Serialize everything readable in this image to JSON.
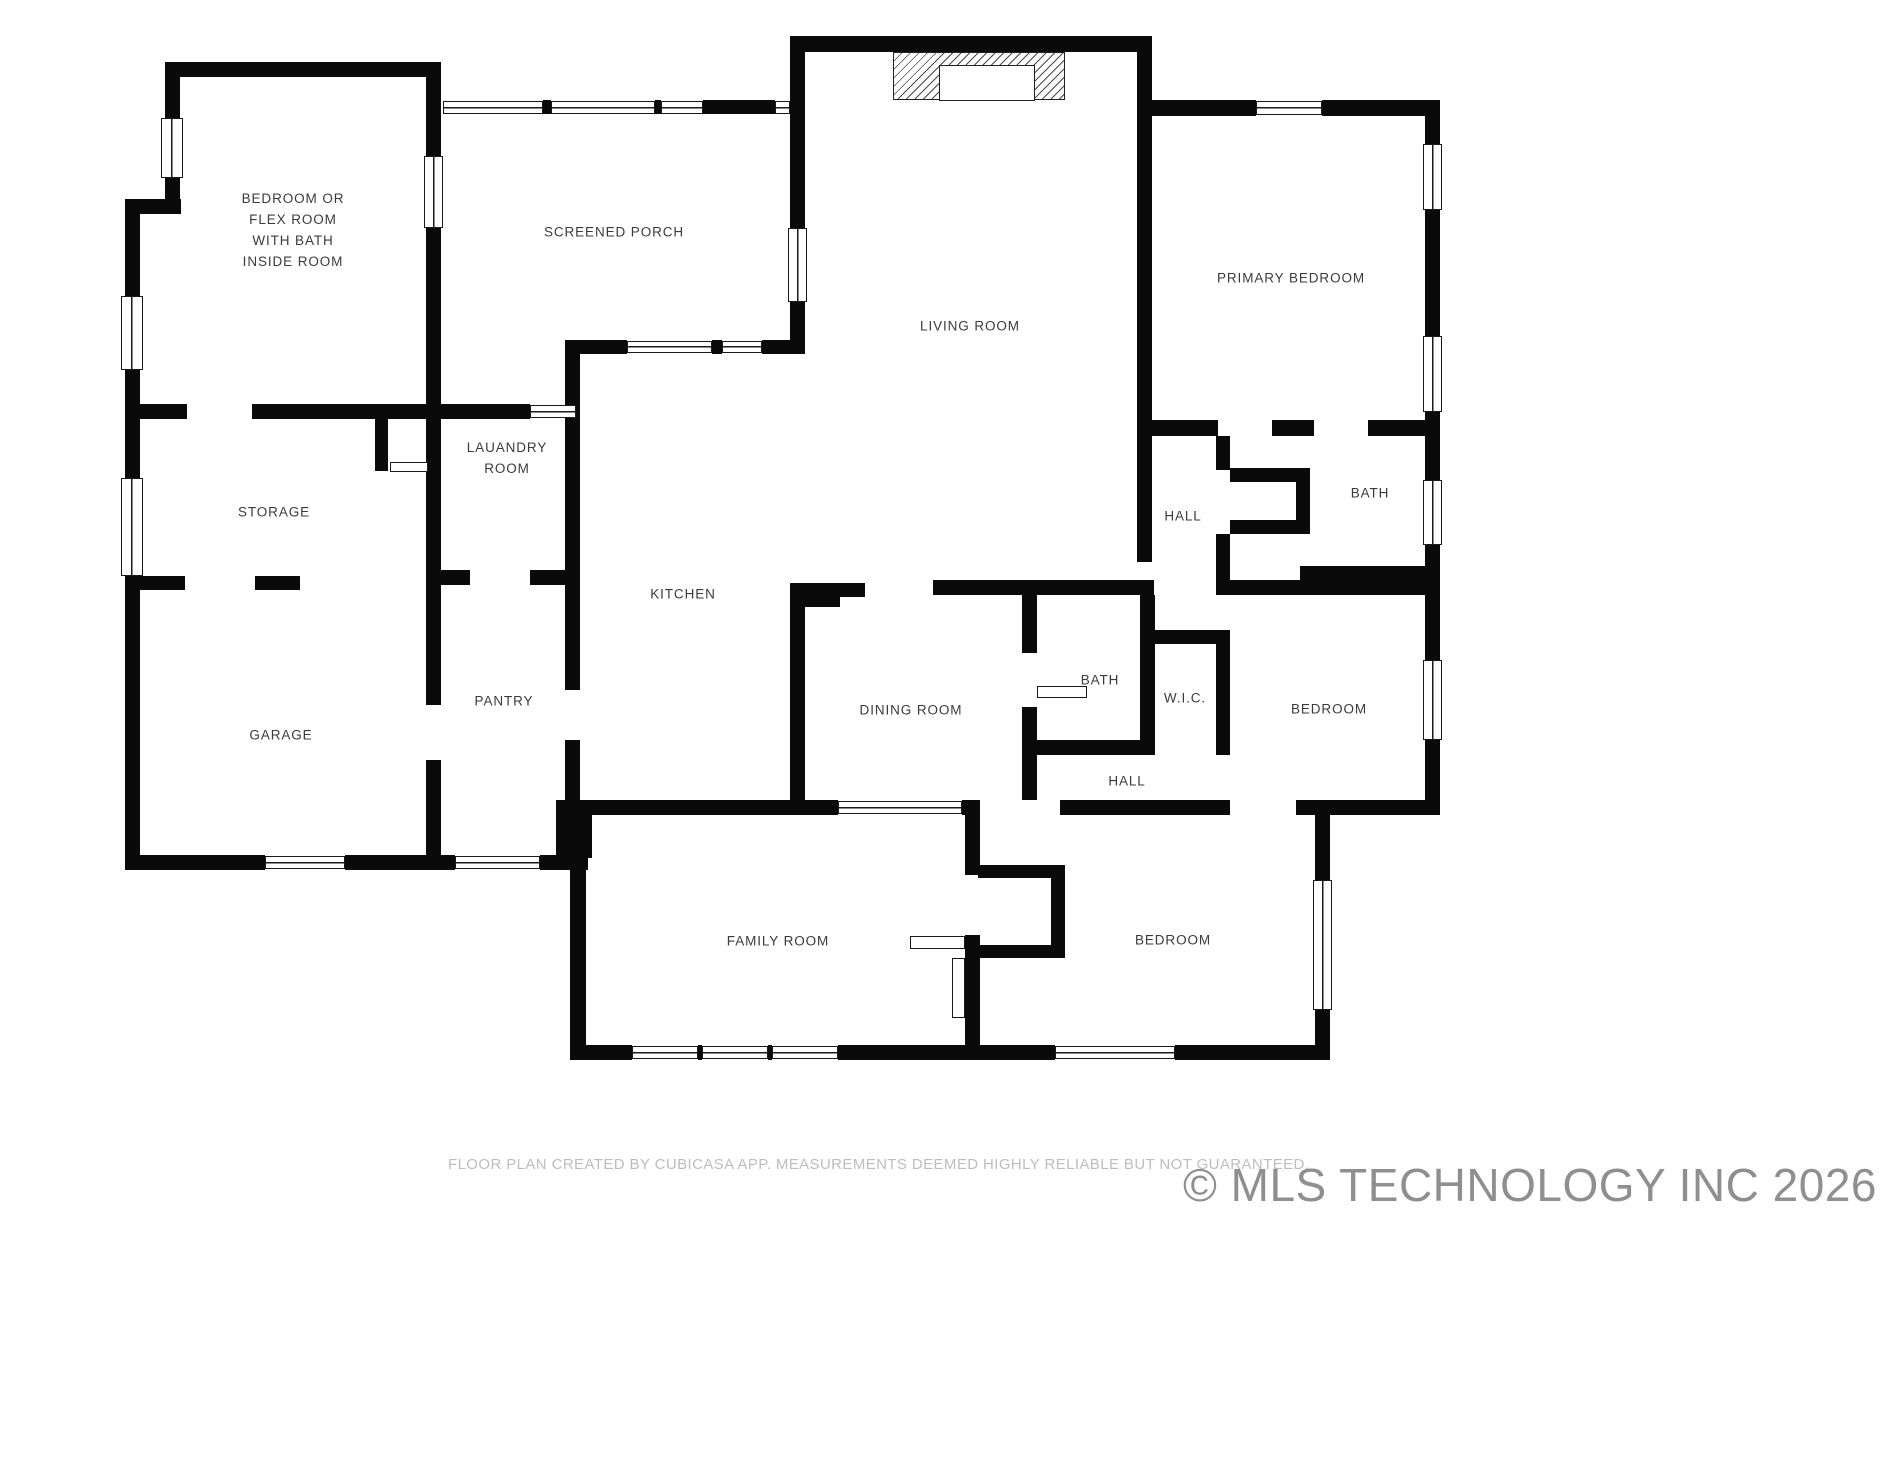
{
  "canvas": {
    "width": 1891,
    "height": 1460,
    "background": "#ffffff",
    "wall_color": "#0a0a0a",
    "label_color": "#3b3b3b"
  },
  "footer": {
    "disclaimer": "FLOOR PLAN CREATED BY CUBICASA APP. MEASUREMENTS DEEMED HIGHLY RELIABLE BUT NOT GUARANTEED."
  },
  "watermark": {
    "text": "© MLS TECHNOLOGY INC 2026"
  },
  "plan": {
    "rooms": [
      {
        "id": "bedroom-flex",
        "label": "BEDROOM OR\nFLEX ROOM\nWITH BATH\nINSIDE ROOM",
        "x": 293,
        "y": 231
      },
      {
        "id": "screened-porch",
        "label": "SCREENED PORCH",
        "x": 614,
        "y": 233
      },
      {
        "id": "living-room",
        "label": "LIVING ROOM",
        "x": 970,
        "y": 327
      },
      {
        "id": "primary-bedroom",
        "label": "PRIMARY BEDROOM",
        "x": 1291,
        "y": 279
      },
      {
        "id": "laundry-room",
        "label": "LAUANDRY\nROOM",
        "x": 507,
        "y": 459
      },
      {
        "id": "storage",
        "label": "STORAGE",
        "x": 274,
        "y": 513
      },
      {
        "id": "hall-upper",
        "label": "HALL",
        "x": 1183,
        "y": 517
      },
      {
        "id": "bath-upper",
        "label": "BATH",
        "x": 1370,
        "y": 494
      },
      {
        "id": "kitchen",
        "label": "KITCHEN",
        "x": 683,
        "y": 595
      },
      {
        "id": "pantry",
        "label": "PANTRY",
        "x": 504,
        "y": 702
      },
      {
        "id": "dining-room",
        "label": "DINING ROOM",
        "x": 911,
        "y": 711
      },
      {
        "id": "bath-middle",
        "label": "BATH",
        "x": 1100,
        "y": 681
      },
      {
        "id": "wic",
        "label": "W.I.C.",
        "x": 1185,
        "y": 699
      },
      {
        "id": "bedroom-right",
        "label": "BEDROOM",
        "x": 1329,
        "y": 710
      },
      {
        "id": "garage",
        "label": "GARAGE",
        "x": 281,
        "y": 736
      },
      {
        "id": "hall-lower",
        "label": "HALL",
        "x": 1127,
        "y": 782
      },
      {
        "id": "family-room",
        "label": "FAMILY ROOM",
        "x": 778,
        "y": 942
      },
      {
        "id": "bedroom-bottom",
        "label": "BEDROOM",
        "x": 1173,
        "y": 941
      }
    ],
    "walls": [
      [
        165,
        62,
        276,
        15
      ],
      [
        165,
        62,
        15,
        58
      ],
      [
        165,
        178,
        15,
        36
      ],
      [
        125,
        199,
        56,
        15
      ],
      [
        125,
        199,
        15,
        99
      ],
      [
        125,
        370,
        15,
        49
      ],
      [
        426,
        62,
        15,
        96
      ],
      [
        426,
        228,
        15,
        357
      ],
      [
        125,
        404,
        62,
        15
      ],
      [
        252,
        404,
        189,
        15
      ],
      [
        375,
        419,
        13,
        52
      ],
      [
        428,
        419,
        13,
        52
      ],
      [
        543,
        100,
        8,
        14
      ],
      [
        655,
        100,
        6,
        14
      ],
      [
        703,
        100,
        72,
        14
      ],
      [
        565,
        340,
        62,
        14
      ],
      [
        712,
        340,
        10,
        14
      ],
      [
        762,
        340,
        28,
        14
      ],
      [
        565,
        340,
        15,
        350
      ],
      [
        441,
        404,
        89,
        15
      ],
      [
        426,
        570,
        44,
        15
      ],
      [
        530,
        570,
        50,
        15
      ],
      [
        125,
        419,
        15,
        60
      ],
      [
        125,
        576,
        60,
        14
      ],
      [
        255,
        576,
        45,
        14
      ],
      [
        125,
        590,
        15,
        265
      ],
      [
        125,
        855,
        140,
        15
      ],
      [
        345,
        855,
        110,
        15
      ],
      [
        540,
        855,
        48,
        15
      ],
      [
        426,
        585,
        15,
        120
      ],
      [
        426,
        760,
        15,
        95
      ],
      [
        556,
        800,
        36,
        58
      ],
      [
        565,
        740,
        15,
        75
      ],
      [
        592,
        800,
        198,
        15
      ],
      [
        790,
        36,
        362,
        16
      ],
      [
        790,
        52,
        15,
        176
      ],
      [
        790,
        302,
        15,
        52
      ],
      [
        1137,
        36,
        15,
        80
      ],
      [
        1137,
        116,
        15,
        446
      ],
      [
        933,
        580,
        104,
        15
      ],
      [
        1037,
        580,
        103,
        15
      ],
      [
        790,
        583,
        15,
        232
      ],
      [
        805,
        583,
        60,
        14
      ],
      [
        805,
        597,
        35,
        10
      ],
      [
        805,
        800,
        33,
        15
      ],
      [
        962,
        800,
        18,
        15
      ],
      [
        1022,
        595,
        15,
        58
      ],
      [
        1022,
        707,
        15,
        93
      ],
      [
        1022,
        740,
        118,
        15
      ],
      [
        1140,
        595,
        15,
        160
      ],
      [
        1140,
        630,
        76,
        14
      ],
      [
        1216,
        630,
        14,
        125
      ],
      [
        1060,
        800,
        170,
        15
      ],
      [
        1296,
        800,
        144,
        15
      ],
      [
        1152,
        100,
        104,
        16
      ],
      [
        1322,
        100,
        118,
        16
      ],
      [
        1425,
        116,
        15,
        28
      ],
      [
        1425,
        210,
        15,
        126
      ],
      [
        1425,
        412,
        15,
        24
      ],
      [
        1152,
        420,
        66,
        16
      ],
      [
        1272,
        420,
        42,
        16
      ],
      [
        1368,
        420,
        72,
        16
      ],
      [
        1216,
        436,
        14,
        34
      ],
      [
        1230,
        468,
        80,
        14
      ],
      [
        1296,
        482,
        14,
        38
      ],
      [
        1230,
        520,
        80,
        14
      ],
      [
        1216,
        534,
        14,
        46
      ],
      [
        1300,
        566,
        125,
        14
      ],
      [
        1425,
        436,
        15,
        44
      ],
      [
        1425,
        545,
        15,
        35
      ],
      [
        1140,
        580,
        14,
        15
      ],
      [
        1216,
        580,
        224,
        15
      ],
      [
        1425,
        595,
        15,
        65
      ],
      [
        1425,
        740,
        15,
        75
      ],
      [
        965,
        815,
        15,
        60
      ],
      [
        965,
        935,
        15,
        125
      ],
      [
        978,
        865,
        87,
        13
      ],
      [
        978,
        945,
        87,
        13
      ],
      [
        1051,
        878,
        14,
        67
      ],
      [
        965,
        1045,
        90,
        15
      ],
      [
        1175,
        1045,
        155,
        15
      ],
      [
        1315,
        815,
        15,
        65
      ],
      [
        1315,
        1010,
        15,
        50
      ],
      [
        570,
        815,
        16,
        245
      ],
      [
        570,
        1045,
        62,
        15
      ],
      [
        838,
        1045,
        127,
        15
      ],
      [
        698,
        1045,
        4,
        15
      ],
      [
        768,
        1045,
        4,
        15
      ]
    ],
    "windows": [
      [
        161,
        118,
        22,
        60,
        "v"
      ],
      [
        121,
        296,
        22,
        74,
        "v"
      ],
      [
        424,
        156,
        19,
        72,
        "v"
      ],
      [
        121,
        478,
        22,
        98,
        "v"
      ],
      [
        443,
        101,
        100,
        13,
        "h"
      ],
      [
        551,
        101,
        104,
        13,
        "h"
      ],
      [
        661,
        101,
        42,
        13,
        "h"
      ],
      [
        775,
        101,
        15,
        13,
        "h"
      ],
      [
        627,
        341,
        85,
        12,
        "h"
      ],
      [
        722,
        341,
        40,
        12,
        "h"
      ],
      [
        530,
        405,
        46,
        13,
        "h"
      ],
      [
        788,
        228,
        19,
        74,
        "v"
      ],
      [
        1256,
        101,
        66,
        14,
        "h"
      ],
      [
        1423,
        144,
        19,
        66,
        "v"
      ],
      [
        1423,
        336,
        19,
        76,
        "v"
      ],
      [
        1423,
        480,
        19,
        65,
        "v"
      ],
      [
        1423,
        660,
        19,
        80,
        "v"
      ],
      [
        1313,
        880,
        19,
        130,
        "v"
      ],
      [
        1055,
        1046,
        120,
        13,
        "h"
      ],
      [
        632,
        1046,
        66,
        13,
        "h"
      ],
      [
        702,
        1046,
        66,
        13,
        "h"
      ],
      [
        772,
        1046,
        66,
        13,
        "h"
      ],
      [
        265,
        856,
        80,
        13,
        "h"
      ],
      [
        455,
        856,
        85,
        13,
        "h"
      ],
      [
        838,
        801,
        124,
        13,
        "h"
      ]
    ],
    "doors": [
      [
        1037,
        686,
        50,
        12
      ],
      [
        910,
        936,
        55,
        13
      ],
      [
        952,
        958,
        13,
        60
      ],
      [
        390,
        462,
        38,
        10
      ]
    ],
    "fireplace": {
      "x": 893,
      "y": 52,
      "w": 172,
      "h": 48,
      "inner": {
        "x": 45,
        "y": 12,
        "w": 96,
        "h": 36
      }
    }
  }
}
